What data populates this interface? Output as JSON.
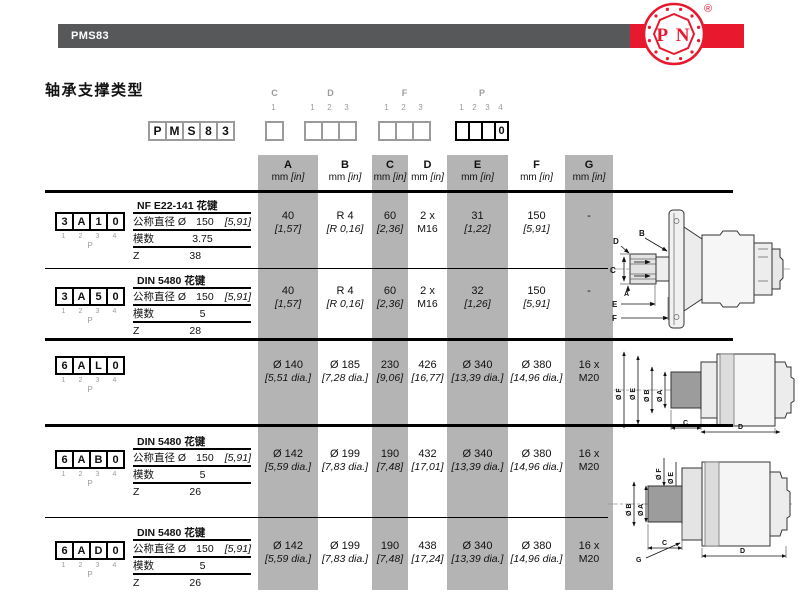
{
  "header": {
    "product_code": "PMS83",
    "logo_text": "P N",
    "registered_mark": "®"
  },
  "title": "轴承支撑类型",
  "code_builder": {
    "prefix": [
      "P",
      "M",
      "S",
      "8",
      "3"
    ],
    "groups": [
      {
        "label": "C",
        "bold": false,
        "positions": [
          "1"
        ],
        "boxes": [
          ""
        ]
      },
      {
        "label": "D",
        "bold": false,
        "positions": [
          "1",
          "2",
          "3"
        ],
        "boxes": [
          "",
          "",
          ""
        ]
      },
      {
        "label": "F",
        "bold": false,
        "positions": [
          "1",
          "2",
          "3"
        ],
        "boxes": [
          "",
          "",
          ""
        ]
      },
      {
        "label": "P",
        "bold": true,
        "positions": [
          "1",
          "2",
          "3",
          "4"
        ],
        "boxes": [
          "",
          "",
          "",
          "0"
        ]
      }
    ]
  },
  "table": {
    "columns": [
      {
        "label": "A",
        "unit_mm": "mm",
        "unit_in": "[in]",
        "shaded": true
      },
      {
        "label": "B",
        "unit_mm": "mm",
        "unit_in": "[in]",
        "shaded": false
      },
      {
        "label": "C",
        "unit_mm": "mm",
        "unit_in": "[in]",
        "shaded": true
      },
      {
        "label": "D",
        "unit_mm": "mm",
        "unit_in": "[in]",
        "shaded": false
      },
      {
        "label": "E",
        "unit_mm": "mm",
        "unit_in": "[in]",
        "shaded": true
      },
      {
        "label": "F",
        "unit_mm": "mm",
        "unit_in": "[in]",
        "shaded": false
      },
      {
        "label": "G",
        "unit_mm": "mm",
        "unit_in": "[in]",
        "shaded": true
      }
    ],
    "rows": [
      {
        "code": [
          "3",
          "A",
          "1",
          "0"
        ],
        "positions": [
          "1",
          "2",
          "3",
          "4"
        ],
        "group_label": "P",
        "spec": {
          "spline": "NF E22-141 花键",
          "diameter_label": "公称直径 Ø",
          "diameter_value": "150",
          "diameter_inch": "[5,91]",
          "module_label": "模数",
          "module_value": "3.75",
          "z_label": "Z",
          "z_value": "38"
        },
        "values": [
          [
            "40",
            "[1,57]"
          ],
          [
            "R 4",
            "[R 0,16]"
          ],
          [
            "60",
            "[2,36]"
          ],
          [
            "2 x",
            "M16"
          ],
          [
            "31",
            "[1,22]"
          ],
          [
            "150",
            "[5,91]"
          ],
          [
            "-",
            ""
          ]
        ]
      },
      {
        "code": [
          "3",
          "A",
          "5",
          "0"
        ],
        "positions": [
          "1",
          "2",
          "3",
          "4"
        ],
        "group_label": "P",
        "spec": {
          "spline": "DIN 5480 花键",
          "diameter_label": "公称直径 Ø",
          "diameter_value": "150",
          "diameter_inch": "[5,91]",
          "module_label": "模数",
          "module_value": "5",
          "z_label": "Z",
          "z_value": "28"
        },
        "values": [
          [
            "40",
            "[1,57]"
          ],
          [
            "R 4",
            "[R 0,16]"
          ],
          [
            "60",
            "[2,36]"
          ],
          [
            "2 x",
            "M16"
          ],
          [
            "32",
            "[1,26]"
          ],
          [
            "150",
            "[5,91]"
          ],
          [
            "-",
            ""
          ]
        ]
      },
      {
        "code": [
          "6",
          "A",
          "L",
          "0"
        ],
        "positions": [
          "1",
          "2",
          "3",
          "4"
        ],
        "group_label": "P",
        "spec": null,
        "values": [
          [
            "Ø 140",
            "[5,51 dia.]"
          ],
          [
            "Ø 185",
            "[7,28 dia.]"
          ],
          [
            "230",
            "[9,06]"
          ],
          [
            "426",
            "[16,77]"
          ],
          [
            "Ø 340",
            "[13,39 dia.]"
          ],
          [
            "Ø 380",
            "[14,96 dia.]"
          ],
          [
            "16 x",
            "M20"
          ]
        ]
      },
      {
        "code": [
          "6",
          "A",
          "B",
          "0"
        ],
        "positions": [
          "1",
          "2",
          "3",
          "4"
        ],
        "group_label": "P",
        "spec": {
          "spline": "DIN 5480 花键",
          "diameter_label": "公称直径 Ø",
          "diameter_value": "150",
          "diameter_inch": "[5,91]",
          "module_label": "模数",
          "module_value": "5",
          "z_label": "Z",
          "z_value": "26"
        },
        "values": [
          [
            "Ø 142",
            "[5,59 dia.]"
          ],
          [
            "Ø 199",
            "[7,83 dia.]"
          ],
          [
            "190",
            "[7,48]"
          ],
          [
            "432",
            "[17,01]"
          ],
          [
            "Ø 340",
            "[13,39 dia.]"
          ],
          [
            "Ø 380",
            "[14,96 dia.]"
          ],
          [
            "16 x",
            "M20"
          ]
        ]
      },
      {
        "code": [
          "6",
          "A",
          "D",
          "0"
        ],
        "positions": [
          "1",
          "2",
          "3",
          "4"
        ],
        "group_label": "P",
        "spec": {
          "spline": "DIN 5480 花键",
          "diameter_label": "公称直径 Ø",
          "diameter_value": "150",
          "diameter_inch": "[5,91]",
          "module_label": "模数",
          "module_value": "5",
          "z_label": "Z",
          "z_value": "26"
        },
        "values": [
          [
            "Ø 142",
            "[5,59 dia.]"
          ],
          [
            "Ø 199",
            "[7,83 dia.]"
          ],
          [
            "190",
            "[7,48]"
          ],
          [
            "438",
            "[17,24]"
          ],
          [
            "Ø 340",
            "[13,39 dia.]"
          ],
          [
            "Ø 380",
            "[14,96 dia.]"
          ],
          [
            "16 x",
            "M20"
          ]
        ]
      }
    ]
  },
  "drawings": [
    {
      "name": "shaft-version",
      "labels": {
        "d": "D",
        "b": "B",
        "c": "C",
        "a": "A",
        "e": "E",
        "f": "F"
      }
    },
    {
      "name": "wheel-version-6al0",
      "labels": {
        "f": "Ø F",
        "e": "Ø E",
        "b": "Ø B",
        "a": "Ø A",
        "c": "C",
        "d": "D"
      }
    },
    {
      "name": "wheel-version-6ab0-6ad0",
      "labels": {
        "f": "Ø F",
        "e": "Ø E",
        "b": "Ø B",
        "a": "Ø A",
        "c": "C",
        "g": "G",
        "d": "D"
      }
    }
  ],
  "colors": {
    "accent_red": "#e8192f",
    "bar_gray": "#57585a",
    "band_gray": "#b4b4b4"
  }
}
